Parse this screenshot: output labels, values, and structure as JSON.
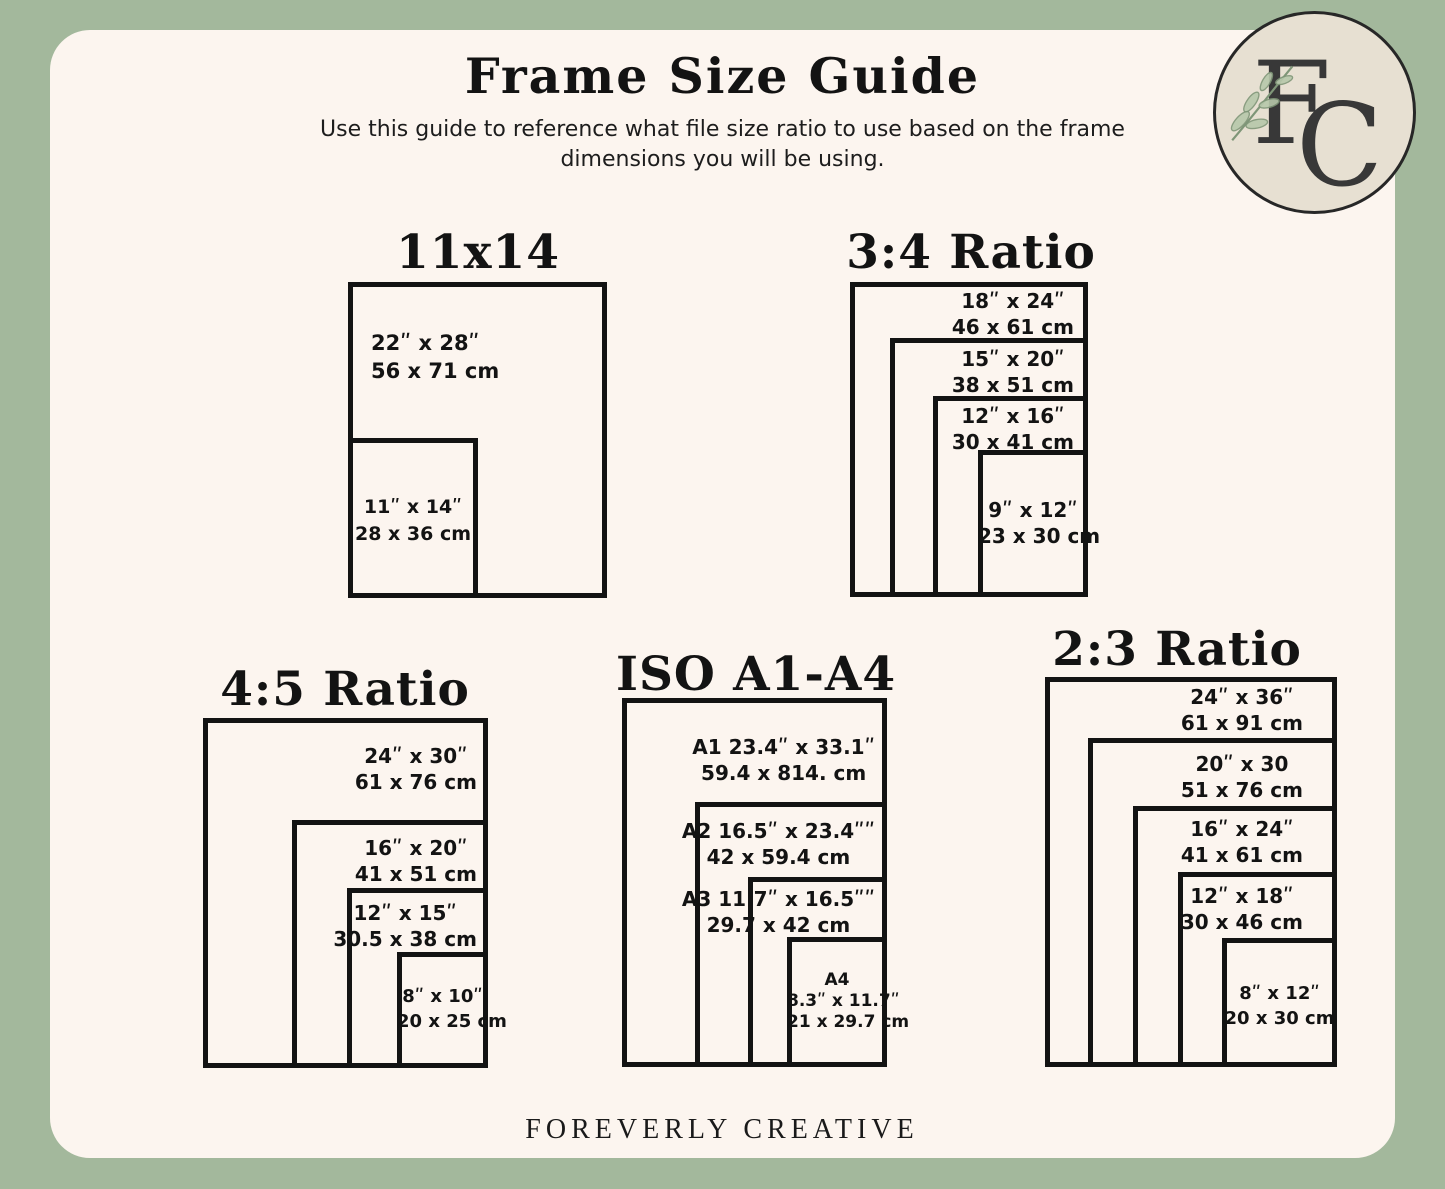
{
  "header": {
    "title": "Frame Size Guide",
    "subtitle_line1": "Use this guide to reference what file size ratio to use based on the frame",
    "subtitle_line2": "dimensions you will be using."
  },
  "logo": {
    "letter_f": "F",
    "letter_c": "C"
  },
  "footer": {
    "brand": "FOREVERLY CREATIVE"
  },
  "colors": {
    "background": "#a3b89c",
    "card": "#fcf5ef",
    "ink": "#131313",
    "logo_circle_fill": "#e7e0d2",
    "logo_letters": "#383838",
    "leaf_green": "#b7c8ab"
  },
  "diagrams": {
    "d11x14": {
      "title": "11x14",
      "frames": [
        {
          "size_in": "22ʺ x 28ʺ",
          "size_cm": "56 x 71 cm"
        },
        {
          "size_in": "11ʺ x 14ʺ",
          "size_cm": "28 x 36 cm"
        }
      ]
    },
    "r34": {
      "title": "3:4 Ratio",
      "frames": [
        {
          "size_in": "18ʺ x 24ʺ",
          "size_cm": "46 x 61 cm"
        },
        {
          "size_in": "15ʺ x 20ʺ",
          "size_cm": "38 x 51 cm"
        },
        {
          "size_in": "12ʺ x 16ʺ",
          "size_cm": "30 x 41 cm"
        },
        {
          "size_in": "9ʺ x 12ʺ",
          "size_cm": "23 x 30 cm"
        }
      ]
    },
    "r45": {
      "title": "4:5 Ratio",
      "frames": [
        {
          "size_in": "24ʺ x 30ʺ",
          "size_cm": "61 x 76 cm"
        },
        {
          "size_in": "16ʺ x 20ʺ",
          "size_cm": "41 x 51 cm"
        },
        {
          "size_in": "12ʺ x 15ʺ",
          "size_cm": "30.5 x 38 cm"
        },
        {
          "size_in": "8ʺ x 10ʺ",
          "size_cm": "20 x 25 cm"
        }
      ]
    },
    "iso": {
      "title": "ISO A1-A4",
      "frames": [
        {
          "size_in": "A1 23.4ʺ x 33.1ʺ",
          "size_cm": "59.4 x 814. cm"
        },
        {
          "size_in": "A2 16.5ʺ x 23.4ʺʺ",
          "size_cm": "42 x 59.4 cm"
        },
        {
          "size_in": "A3 11.7ʺ x 16.5ʺʺ",
          "size_cm": "29.7 x 42 cm"
        },
        {
          "name": "A4",
          "size_in": "8.3ʺ x 11.7ʺ",
          "size_cm": "21 x 29.7 cm"
        }
      ]
    },
    "r23": {
      "title": "2:3 Ratio",
      "frames": [
        {
          "size_in": "24ʺ x 36ʺ",
          "size_cm": "61 x 91 cm"
        },
        {
          "size_in": "20ʺ x 30",
          "size_cm": "51 x 76 cm"
        },
        {
          "size_in": "16ʺ x 24ʺ",
          "size_cm": "41 x 61 cm"
        },
        {
          "size_in": "12ʺ x 18ʺ",
          "size_cm": "30 x 46 cm"
        },
        {
          "size_in": "8ʺ x 12ʺ",
          "size_cm": "20 x 30 cm"
        }
      ]
    }
  }
}
